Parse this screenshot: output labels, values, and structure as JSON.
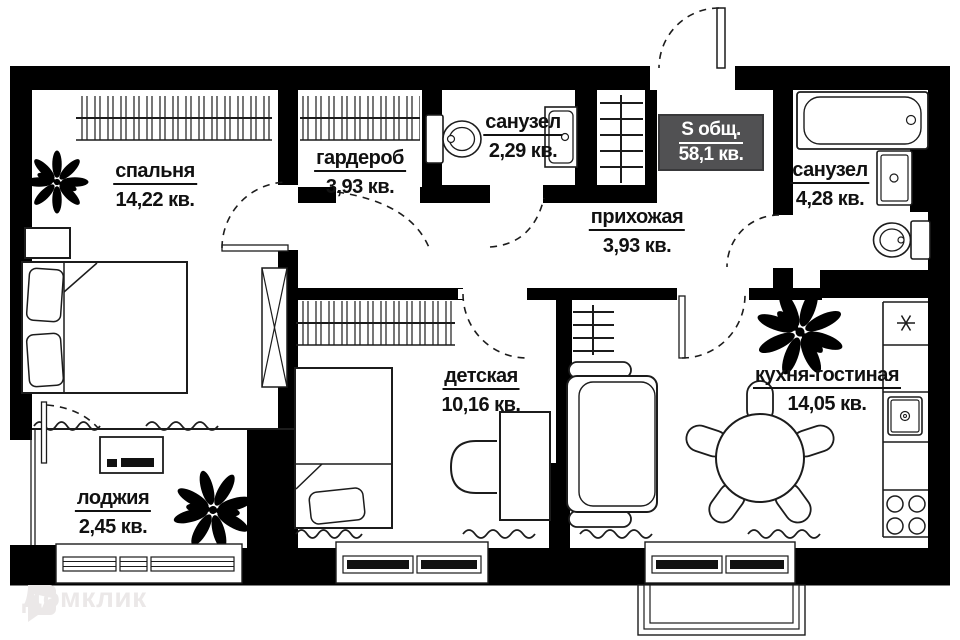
{
  "plan": {
    "total_badge": {
      "label": "S общ.",
      "area": "58,1 кв."
    },
    "rooms": [
      {
        "id": "bedroom",
        "name": "спальня",
        "area": "14,22 кв."
      },
      {
        "id": "wardrobe",
        "name": "гардероб",
        "area": "3,93 кв."
      },
      {
        "id": "bathroom-small",
        "name": "санузел",
        "area": "2,29 кв."
      },
      {
        "id": "hallway",
        "name": "прихожая",
        "area": "3,93 кв."
      },
      {
        "id": "bathroom",
        "name": "санузел",
        "area": "4,28 кв."
      },
      {
        "id": "kids-room",
        "name": "детская",
        "area": "10,16 кв."
      },
      {
        "id": "kitchen-living",
        "name": "кухня-гостиная",
        "area": "14,05 кв."
      },
      {
        "id": "loggia",
        "name": "лоджия",
        "area": "2,45 кв."
      }
    ]
  },
  "watermark": {
    "text": "Домклик"
  },
  "colors": {
    "wall": "#000000",
    "line": "#1c1c1c",
    "badge_bg": "#515153",
    "badge_text": "#ffffff",
    "paper": "#ffffff",
    "watermark": "#ebe8e8"
  }
}
